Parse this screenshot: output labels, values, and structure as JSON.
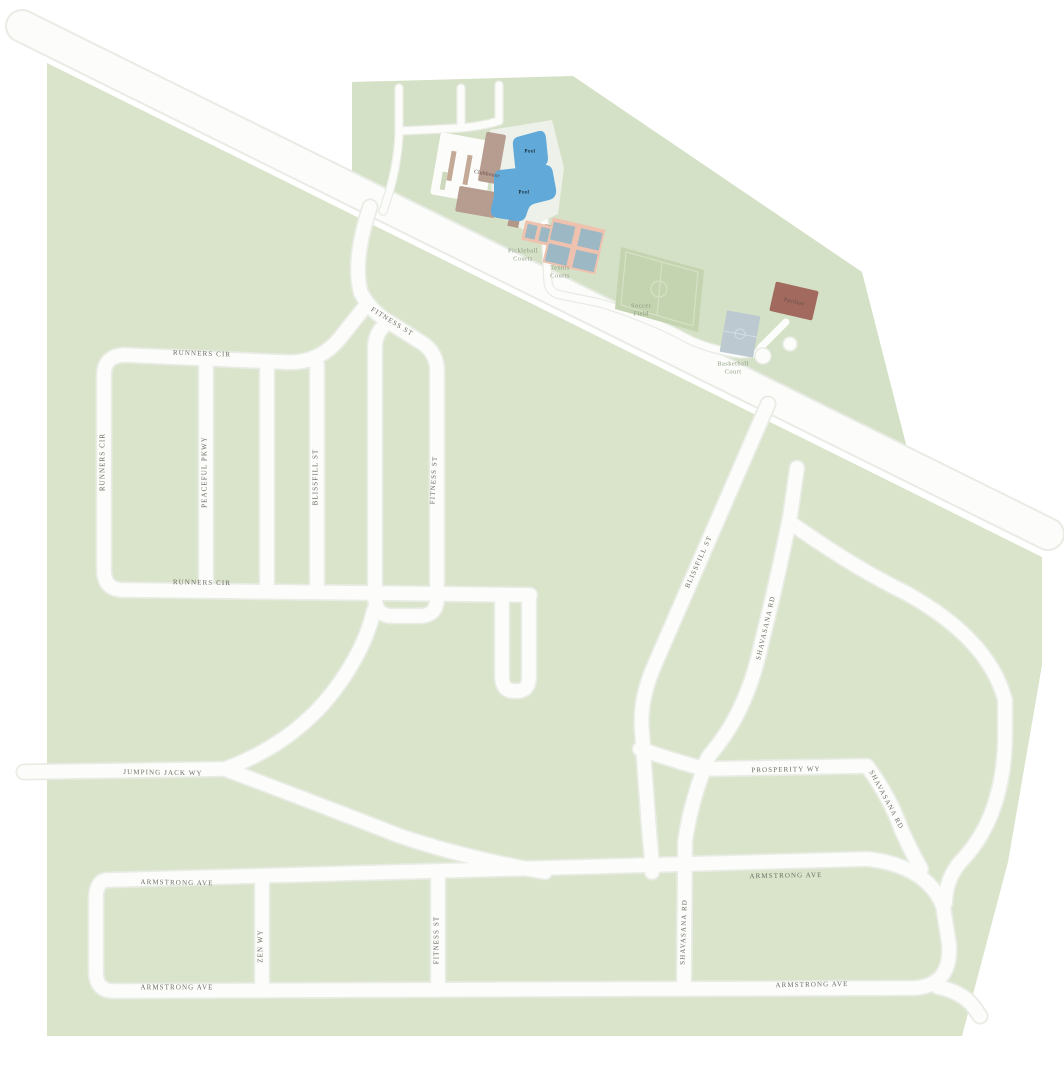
{
  "map": {
    "type": "community-site-plan",
    "street_labels": [
      {
        "label": "RUNNERS CIR"
      },
      {
        "label": "RUNNERS CIR"
      },
      {
        "label": "RUNNERS CIR"
      },
      {
        "label": "PEACEFUL PKWY"
      },
      {
        "label": "BLISSFILL ST"
      },
      {
        "label": "FITNESS ST"
      },
      {
        "label": "FITNESS ST"
      },
      {
        "label": "BLISSFILL ST"
      },
      {
        "label": "SHAVASANA RD"
      },
      {
        "label": "JUMPING JACK WY"
      },
      {
        "label": "PROSPERITY WY"
      },
      {
        "label": "SHAVASANA RD"
      },
      {
        "label": "ARMSTRONG AVE"
      },
      {
        "label": "ARMSTRONG AVE"
      },
      {
        "label": "ZEN WY"
      },
      {
        "label": "FITNESS ST"
      },
      {
        "label": "SHAVASANA RD"
      },
      {
        "label": "ARMSTRONG AVE"
      },
      {
        "label": "ARMSTRONG AVE"
      }
    ],
    "amenity_labels": {
      "pickleball_line1": "Pickleball",
      "pickleball_line2": "Courts",
      "tennis_line1": "Tennis",
      "tennis_line2": "Courts",
      "soccer_line1": "Soccer",
      "soccer_line2": "Field",
      "basketball_line1": "Basketball",
      "basketball_line2": "Court",
      "pavilion": "Pavilion",
      "clubhouse": "Clubhouse",
      "pool_main": "Pool",
      "pool_small": "Pool"
    },
    "colors": {
      "background": "#ffffff",
      "green_main": "#d9e4cb",
      "green_campus": "#d5e1c6",
      "soccer_field": "#c4d3b0",
      "field_line": "#d7e2c5",
      "road_fill": "#fcfdfa",
      "road_casing": "#e8ece4",
      "arterial_fill": "#eef0ec",
      "arterial_casing": "#e3e7e0",
      "pool": "#60a9d8",
      "pool_deck": "#edf1ea",
      "clubhouse_building": "#b79c90",
      "hut": "#b29789",
      "pavilion_building": "#a26a5e",
      "basketball_court": "#bcc9d1",
      "tennis_court_bg": "#eec2af",
      "tennis_court_inner": "#9bb8c4",
      "parking_island": "#c3a996",
      "street_label_text": "#6c6d65",
      "amenity_label_text": "#8d9b82",
      "pool_label_text": "#397cab"
    }
  }
}
